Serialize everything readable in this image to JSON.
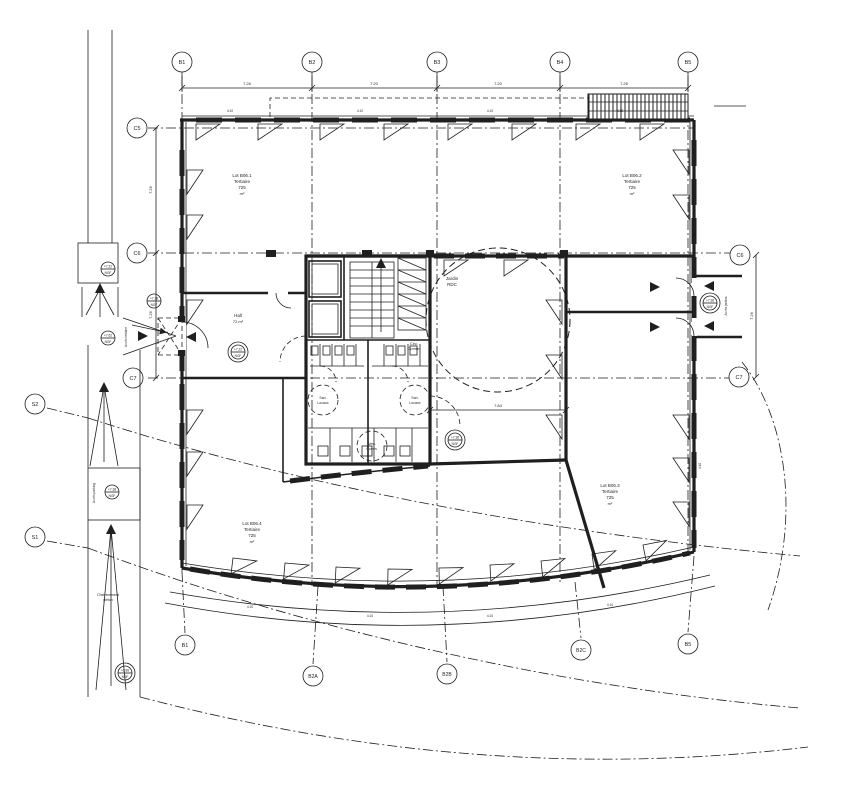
{
  "colors": {
    "ink": "#1f1f1f",
    "background": "#ffffff"
  },
  "grid_markers": {
    "top": [
      {
        "label": "B1"
      },
      {
        "label": "B2"
      },
      {
        "label": "B3"
      },
      {
        "label": "B4"
      },
      {
        "label": "B5"
      }
    ],
    "bottom": [
      {
        "label": "B1"
      },
      {
        "label": "B2A"
      },
      {
        "label": "B2B"
      },
      {
        "label": "B2C"
      },
      {
        "label": "B5"
      }
    ],
    "left": [
      {
        "label": "C5"
      },
      {
        "label": "C6"
      },
      {
        "label": "C7"
      }
    ],
    "right": [
      {
        "label": "C6"
      },
      {
        "label": "C7"
      }
    ],
    "site": [
      {
        "label": "S2"
      },
      {
        "label": "S1"
      }
    ]
  },
  "dimensions": {
    "top_bays": [
      "7.26",
      "7.20",
      "7.20",
      "7.26"
    ],
    "left_bays": [
      "7.26",
      "7.26"
    ],
    "right_bay": "7.26",
    "module": "4.10",
    "garden_width": "7.84"
  },
  "rooms": {
    "lot_nw": {
      "l1": "Lot B06.1",
      "l2": "Tertiaire",
      "l3": "725",
      "l4": "m²"
    },
    "lot_ne": {
      "l1": "Lot B06.2",
      "l2": "Tertiaire",
      "l3": "725",
      "l4": "m²"
    },
    "lot_sw": {
      "l1": "Lot B06.4",
      "l2": "Tertiaire",
      "l3": "725",
      "l4": "m²"
    },
    "lot_se": {
      "l1": "Lot B06.3",
      "l2": "Tertiaire",
      "l3": "725",
      "l4": "m²"
    },
    "hall": {
      "l1": "Hall",
      "l2": "72 m²"
    },
    "jardin": {
      "l1": "Jardin",
      "l2": "RDC"
    },
    "circ": {
      "l1": "Circ.",
      "l2": "Comm."
    },
    "san_left": {
      "l1": "San.",
      "l2": "Locaux"
    },
    "san_right": {
      "l1": "San.",
      "l2": "Locaux"
    },
    "vest": {
      "l1": "Vest.",
      "l2": "Comm."
    }
  },
  "levels": [
    {
      "v": "+7.22",
      "d": "NGF"
    },
    {
      "v": "+7.38",
      "d": "NGF"
    },
    {
      "v": "+7.62",
      "d": "NGF"
    },
    {
      "v": "+7.22",
      "d": "NGF"
    },
    {
      "v": "+7.38",
      "d": "NGF"
    },
    {
      "v": "+7.38",
      "d": "NGF"
    },
    {
      "v": "+6.98",
      "d": "NGF"
    },
    {
      "v": "+7.38",
      "d": "NGF"
    }
  ],
  "annotations": {
    "acces_right": "Accès jardins",
    "acces_entry": "Accès tertiaire",
    "acces_parking": "Accès parking",
    "site_note_l1": "Cheminement",
    "site_note_l2": "piéton"
  }
}
